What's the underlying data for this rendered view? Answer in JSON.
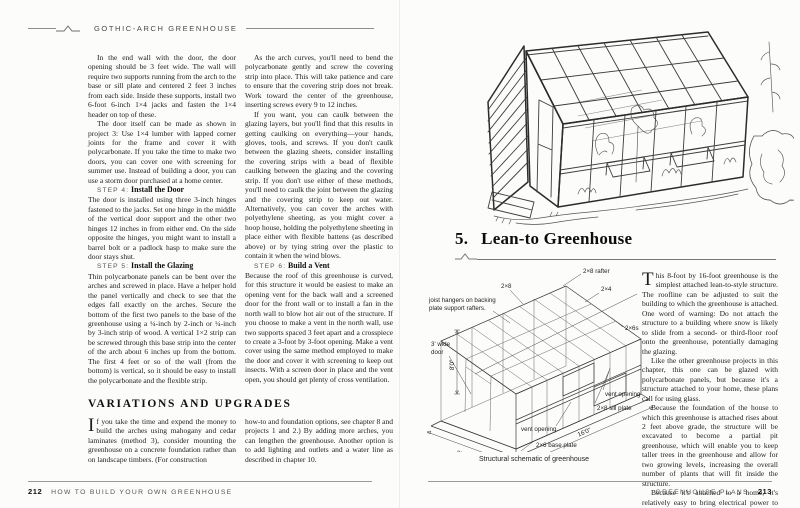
{
  "left_page": {
    "header": "GOTHIC-ARCH GREENHOUSE",
    "col1": {
      "para1": "In the end wall with the door, the door opening should be 3 feet wide. The wall will require two supports running from the arch to the base or sill plate and centered 2 feet 3 inches from each side. Inside these supports, install two 6-foot 6-inch 1×4 jacks and fasten the 1×4 header on top of these.",
      "para2": "The door itself can be made as shown in project 3: Use 1×4 lumber with lapped corner joints for the frame and cover it with polycarbonate. If you take the time to make two doors, you can cover one with screening for summer use. Instead of building a door, you can use a storm door purchased at a home center.",
      "step4_label": "STEP 4:",
      "step4_title": "Install the Door",
      "step4_body": "The door is installed using three 3-inch hinges fastened to the jacks. Set one hinge in the middle of the vertical door support and the other two hinges 12 inches in from either end. On the side opposite the hinges, you might want to install a barrel bolt or a padlock hasp to make sure the door stays shut.",
      "step5_label": "STEP 5:",
      "step5_title": "Install the Glazing",
      "step5_body": "Thin polycarbonate panels can be bent over the arches and screwed in place. Have a helper hold the panel vertically and check to see that the edges fall exactly on the arches. Secure the bottom of the first two panels to the base of the greenhouse using a ¼-inch by 2-inch or ¼-inch by 3-inch strip of wood. A vertical 1×2 strip can be screwed through this base strip into the center of the arch about 6 inches up from the bottom. The first 4 feet or so of the wall (from the bottom) is vertical, so it should be easy to install the polycarbonate and the flexible strip."
    },
    "col2": {
      "para1": "As the arch curves, you'll need to bend the polycarbonate gently and screw the covering strip into place. This will take patience and care to ensure that the covering strip does not break. Work toward the center of the greenhouse, inserting screws every 9 to 12 inches.",
      "para2": "If you want, you can caulk between the glazing layers, but you'll find that this results in getting caulking on everything—your hands, gloves, tools, and screws. If you don't caulk between the glazing sheets, consider installing the covering strips with a bead of flexible caulking between the glazing and the covering strip. If you don't use either of these methods, you'll need to caulk the joint between the glazing and the covering strip to keep out water. Alternatively, you can cover the arches with polyethylene sheeting, as you might cover a hoop house, holding the polyethylene sheeting in place either with flexible battens (as described above) or by tying string over the plastic to contain it when the wind blows.",
      "step6_label": "STEP 6:",
      "step6_title": "Build a Vent",
      "step6_body": "Because the roof of this greenhouse is curved, for this structure it would be easiest to make an opening vent for the back wall and a screened door for the front wall or to install a fan in the north wall to blow hot air out of the structure. If you choose to make a vent in the north wall, use two supports spaced 3 feet apart and a crosspiece to create a 3-foot by 3-foot opening. Make a vent cover using the same method employed to make the door and cover it with screening to keep out insects. With a screen door in place and the vent open, you should get plenty of cross ventilation."
    },
    "variations": {
      "heading": "VARIATIONS AND UPGRADES",
      "col1_dropcap": "I",
      "col1_rest": "f you take the time and expend the money to build the arches using mahogany and cedar laminates (method 3), consider mounting the greenhouse on a concrete foundation rather than on landscape timbers. (For construction",
      "col2": "how-to and foundation options, see chapter 8 and projects 1 and 2.) By adding more arches, you can lengthen the greenhouse. Another option is to add lighting and outlets and a water line as described in chapter 10."
    },
    "footer": {
      "page": "212",
      "title": "HOW TO BUILD YOUR OWN GREENHOUSE"
    }
  },
  "right_page": {
    "heading": {
      "number": "5.",
      "title": "Lean-to Greenhouse"
    },
    "body": {
      "dropcap": "T",
      "para1_rest": "his 8-foot by 16-foot greenhouse is the simplest attached lean-to-style structure. The roofline can be adjusted to suit the building to which the greenhouse is attached. One word of warning: Do not attach the structure to a building where snow is likely to slide from a second- or third-floor roof onto the greenhouse, potentially damaging the glazing.",
      "para2": "Like the other greenhouse projects in this chapter, this one can be glazed with polycarbonate panels, but because it's a structure attached to your home, these plans call for using glass.",
      "para3": "Because the foundation of the house to which this greenhouse is attached rises about 2 feet above grade, the structure will be excavated to become a partial pit greenhouse, which will enable you to keep taller trees in the greenhouse and allow for two growing levels, increasing the overall number of plants that will fit inside the structure.",
      "para4": "Because it's attached to a home, it's relatively easy to bring electrical power to the structure,"
    },
    "schematic": {
      "caption": "Structural schematic of greenhouse",
      "labels": {
        "rafter": "2×8 rafter",
        "two_by_eight": "2×8",
        "two_by_four": "2×4",
        "two_by_sixes": "2×6s",
        "joist_line1": "joist hangers on backing",
        "joist_line2": "plate support rafters.",
        "door_line1": "3' wide",
        "door_line2": "door",
        "height": "8'0\"",
        "depth": "8'0\"",
        "length": "16'0\"",
        "vent_upper": "vent opening",
        "vent_lower": "vent opening",
        "sill": "2×8 sill plate",
        "base": "2×6 base plate"
      }
    },
    "footer": {
      "title": "GREENHOUSE PLANS",
      "page": "213"
    }
  }
}
